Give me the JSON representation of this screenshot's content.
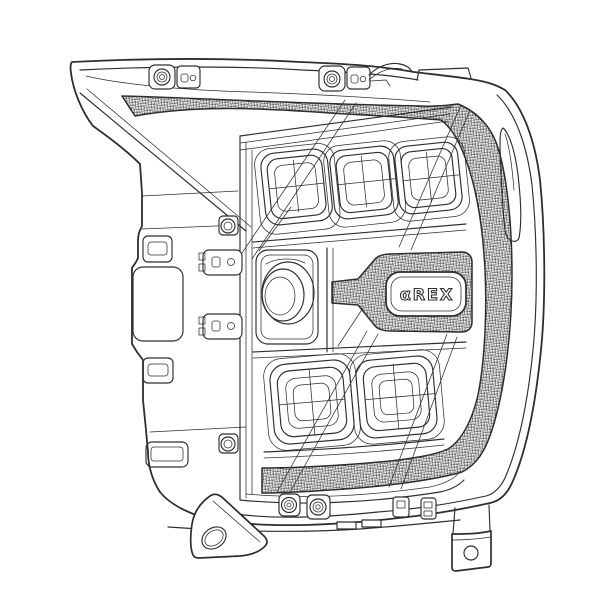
{
  "illustration": {
    "description": "Black-and-white technical line drawing of a truck LED headlight assembly (front/side view) with cross-hatched light bars",
    "logo_text": "αREX",
    "colors": {
      "background": "#ffffff",
      "line": "#2e2e2e"
    }
  },
  "parts": [
    "housing-shell",
    "top-wing",
    "top-drl-strip",
    "side-drl-tube",
    "bottom-drl-strip",
    "high-beam-projector-1",
    "high-beam-projector-2",
    "high-beam-projector-3",
    "turn-signal-projector",
    "low-beam-projector-1",
    "low-beam-projector-2",
    "alpharex-badge",
    "left-mounting-foot",
    "right-mounting-bracket",
    "adjuster-screws",
    "retainer-clips",
    "side-reflector-blade"
  ]
}
